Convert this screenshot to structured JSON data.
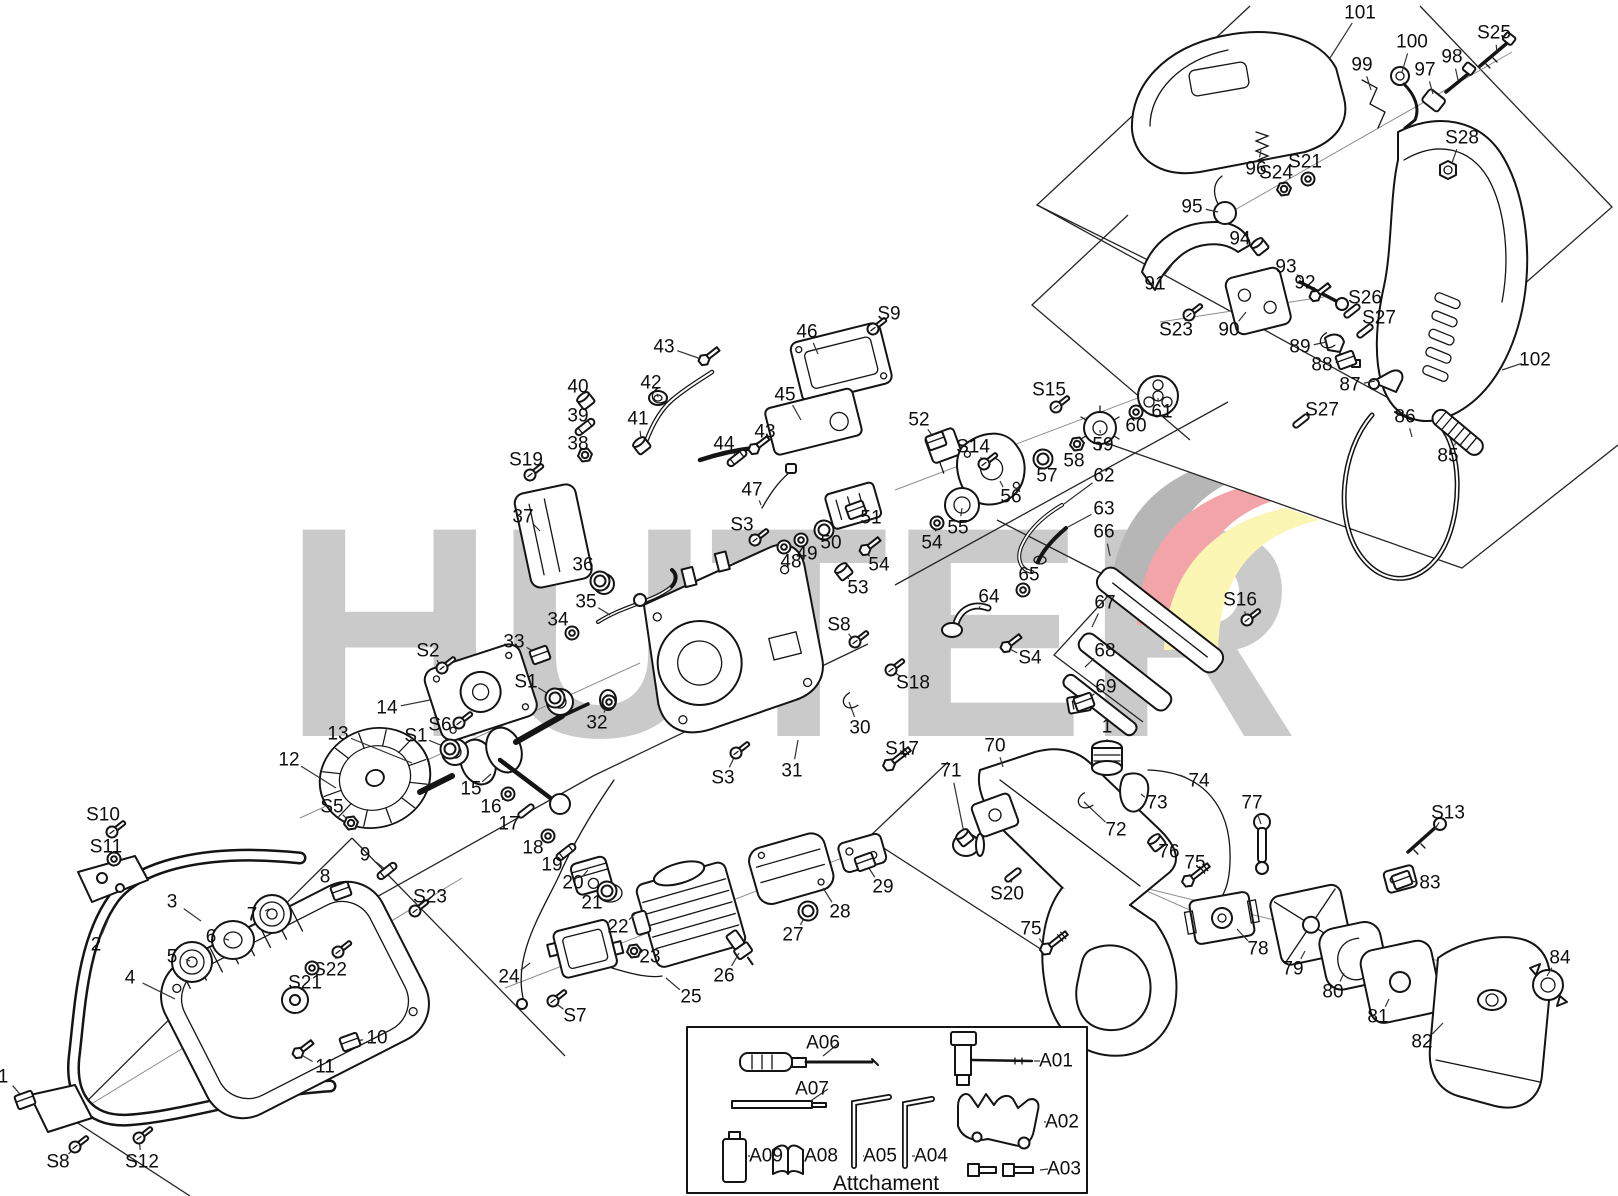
{
  "watermark": {
    "text": "HUTER",
    "letter_color": "#cacaca",
    "flag_colors": {
      "gray": "#b6b6b6",
      "red": "#f2a4a9",
      "yellow": "#fbf6b4"
    }
  },
  "attachment_box": {
    "caption": "Attchament",
    "items": [
      {
        "label": "A06",
        "x": 823,
        "y": 1043,
        "lx": 823,
        "ly": 1056
      },
      {
        "label": "A07",
        "x": 812,
        "y": 1089,
        "lx": 812,
        "ly": 1100
      },
      {
        "label": "A09",
        "x": 766,
        "y": 1156,
        "lx": 748,
        "ly": 1156
      },
      {
        "label": "A08",
        "x": 821,
        "y": 1156,
        "lx": 805,
        "ly": 1156
      },
      {
        "label": "A05",
        "x": 880,
        "y": 1156,
        "lx": 863,
        "ly": 1156
      },
      {
        "label": "A04",
        "x": 931,
        "y": 1156,
        "lx": 912,
        "ly": 1156
      },
      {
        "label": "A01",
        "x": 1056,
        "y": 1061,
        "lx": 1034,
        "ly": 1061
      },
      {
        "label": "A02",
        "x": 1062,
        "y": 1122,
        "lx": 1044,
        "ly": 1122
      },
      {
        "label": "A03",
        "x": 1064,
        "y": 1169,
        "lx": 1040,
        "ly": 1170
      }
    ]
  },
  "diagram": {
    "labels": [
      [
        "101",
        1360,
        13,
        1330,
        58,
        ""
      ],
      [
        "100",
        1412,
        42,
        1402,
        72,
        ""
      ],
      [
        "99",
        1362,
        65,
        1371,
        90,
        ""
      ],
      [
        "98",
        1452,
        57,
        1458,
        80,
        ""
      ],
      [
        "97",
        1425,
        70,
        1433,
        94,
        ""
      ],
      [
        "S25",
        1494,
        33,
        1497,
        52,
        ""
      ],
      [
        "S28",
        1462,
        138,
        1452,
        163,
        ""
      ],
      [
        "96",
        1256,
        169,
        1261,
        150,
        ""
      ],
      [
        "S24",
        1276,
        173,
        1284,
        189,
        "nut"
      ],
      [
        "S21",
        1305,
        162,
        1308,
        179,
        "washer"
      ],
      [
        "95",
        1192,
        207,
        1218,
        212,
        ""
      ],
      [
        "94",
        1240,
        239,
        1260,
        247,
        "cap"
      ],
      [
        "93",
        1286,
        267,
        1301,
        279,
        ""
      ],
      [
        "92",
        1305,
        283,
        1315,
        296,
        "bolt"
      ],
      [
        "91",
        1155,
        284,
        1172,
        265,
        ""
      ],
      [
        "90",
        1229,
        330,
        1246,
        312,
        ""
      ],
      [
        "S23",
        1176,
        330,
        1189,
        315,
        "screw"
      ],
      [
        "S26",
        1365,
        298,
        1352,
        311,
        "pin"
      ],
      [
        "S27",
        1379,
        318,
        1365,
        331,
        "pin"
      ],
      [
        "89",
        1300,
        347,
        1326,
        342,
        "clip"
      ],
      [
        "88",
        1322,
        365,
        1346,
        360,
        "block"
      ],
      [
        "87",
        1350,
        385,
        1375,
        381,
        ""
      ],
      [
        "102",
        1535,
        360,
        1502,
        370,
        ""
      ],
      [
        "86",
        1405,
        417,
        1412,
        437,
        ""
      ],
      [
        "85",
        1448,
        456,
        1456,
        441,
        ""
      ],
      [
        "S27",
        1322,
        410,
        1301,
        421,
        "pin"
      ],
      [
        "S15",
        1049,
        390,
        1056,
        407,
        "screw"
      ],
      [
        "S16",
        1240,
        600,
        1247,
        620,
        "screw"
      ],
      [
        "52",
        919,
        420,
        936,
        441,
        "block"
      ],
      [
        "S14",
        973,
        447,
        984,
        464,
        "screw"
      ],
      [
        "56",
        1011,
        497,
        1000,
        481,
        ""
      ],
      [
        "57",
        1047,
        476,
        1043,
        459,
        "ring"
      ],
      [
        "58",
        1074,
        461,
        1077,
        444,
        "nut"
      ],
      [
        "59",
        1103,
        445,
        1100,
        430,
        ""
      ],
      [
        "60",
        1136,
        426,
        1136,
        412,
        "washer"
      ],
      [
        "61",
        1162,
        412,
        1158,
        398,
        ""
      ],
      [
        "55",
        958,
        528,
        962,
        508,
        ""
      ],
      [
        "54",
        932,
        543,
        937,
        523,
        "washer"
      ],
      [
        "62",
        1104,
        476,
        1064,
        504,
        ""
      ],
      [
        "63",
        1104,
        509,
        1068,
        527,
        ""
      ],
      [
        "66",
        1104,
        532,
        1110,
        556,
        ""
      ],
      [
        "65",
        1029,
        575,
        1023,
        590,
        "washer"
      ],
      [
        "64",
        989,
        597,
        979,
        609,
        ""
      ],
      [
        "S4",
        1030,
        658,
        1006,
        647,
        "bolt"
      ],
      [
        "67",
        1105,
        603,
        1092,
        627,
        ""
      ],
      [
        "68",
        1105,
        651,
        1085,
        667,
        ""
      ],
      [
        "69",
        1106,
        687,
        1084,
        702,
        "block"
      ],
      [
        "S18",
        913,
        683,
        891,
        670,
        "screw"
      ],
      [
        "S8",
        839,
        625,
        855,
        642,
        "screw"
      ],
      [
        "30",
        860,
        728,
        849,
        702,
        "clip"
      ],
      [
        "S17",
        902,
        749,
        889,
        765,
        "lbolt"
      ],
      [
        "1",
        1107,
        727,
        1107,
        741,
        ""
      ],
      [
        "S9",
        889,
        314,
        873,
        329,
        "screw"
      ],
      [
        "46",
        807,
        332,
        818,
        354,
        ""
      ],
      [
        "43",
        664,
        347,
        704,
        360,
        "bolt"
      ],
      [
        "42",
        651,
        383,
        658,
        397,
        "clip"
      ],
      [
        "40",
        578,
        387,
        586,
        401,
        "cap"
      ],
      [
        "39",
        578,
        416,
        585,
        427,
        "tube"
      ],
      [
        "38",
        578,
        444,
        585,
        455,
        "nut"
      ],
      [
        "41",
        638,
        419,
        642,
        446,
        "cap"
      ],
      [
        "S19",
        526,
        460,
        530,
        475,
        "screw"
      ],
      [
        "37",
        523,
        517,
        540,
        531,
        ""
      ],
      [
        "44",
        724,
        444,
        737,
        458,
        "tube"
      ],
      [
        "43",
        765,
        432,
        754,
        449,
        "bolt"
      ],
      [
        "45",
        785,
        395,
        801,
        420,
        ""
      ],
      [
        "47",
        752,
        490,
        761,
        505,
        ""
      ],
      [
        "S3",
        742,
        525,
        755,
        540,
        "screw"
      ],
      [
        "48",
        791,
        562,
        784,
        547,
        "washer"
      ],
      [
        "49",
        807,
        554,
        801,
        540,
        "washer"
      ],
      [
        "50",
        831,
        543,
        824,
        530,
        "ring"
      ],
      [
        "51",
        871,
        518,
        856,
        510,
        "block"
      ],
      [
        "53",
        858,
        588,
        844,
        572,
        "cap"
      ],
      [
        "54",
        879,
        565,
        865,
        550,
        "bolt"
      ],
      [
        "36",
        583,
        565,
        600,
        581,
        "ring"
      ],
      [
        "35",
        586,
        602,
        610,
        615,
        ""
      ],
      [
        "34",
        558,
        620,
        572,
        633,
        "washer"
      ],
      [
        "33",
        514,
        642,
        540,
        655,
        "block"
      ],
      [
        "S2",
        428,
        651,
        442,
        668,
        "screw"
      ],
      [
        "S1",
        526,
        682,
        555,
        698,
        "ring"
      ],
      [
        "32",
        597,
        723,
        609,
        702,
        "washer"
      ],
      [
        "14",
        387,
        708,
        430,
        700,
        ""
      ],
      [
        "S6",
        440,
        725,
        459,
        723,
        "screw"
      ],
      [
        "S1",
        416,
        736,
        450,
        749,
        "ring"
      ],
      [
        "13",
        338,
        734,
        412,
        763,
        ""
      ],
      [
        "12",
        289,
        760,
        336,
        788,
        ""
      ],
      [
        "S5",
        332,
        807,
        351,
        823,
        "nut"
      ],
      [
        "15",
        471,
        789,
        491,
        774,
        ""
      ],
      [
        "16",
        491,
        807,
        508,
        794,
        "washer"
      ],
      [
        "17",
        509,
        824,
        526,
        811,
        "pin"
      ],
      [
        "18",
        533,
        848,
        548,
        836,
        "washer"
      ],
      [
        "19",
        552,
        865,
        566,
        852,
        "tube"
      ],
      [
        "20",
        573,
        883,
        588,
        870,
        ""
      ],
      [
        "21",
        592,
        903,
        607,
        891,
        "ring"
      ],
      [
        "22",
        618,
        927,
        635,
        914,
        ""
      ],
      [
        "23",
        650,
        957,
        634,
        951,
        "nut"
      ],
      [
        "24",
        509,
        977,
        530,
        963,
        ""
      ],
      [
        "25",
        691,
        997,
        666,
        978,
        ""
      ],
      [
        "26",
        724,
        976,
        739,
        953,
        ""
      ],
      [
        "27",
        793,
        935,
        808,
        911,
        "ring"
      ],
      [
        "28",
        840,
        912,
        823,
        888,
        ""
      ],
      [
        "29",
        883,
        887,
        865,
        862,
        "block"
      ],
      [
        "31",
        792,
        771,
        798,
        740,
        ""
      ],
      [
        "S3",
        723,
        778,
        736,
        753,
        "screw"
      ],
      [
        "S7",
        575,
        1016,
        553,
        1001,
        "screw"
      ],
      [
        "S10",
        103,
        815,
        112,
        832,
        "screw"
      ],
      [
        "S11",
        106,
        847,
        114,
        859,
        "washer"
      ],
      [
        "2",
        96,
        945,
        108,
        920,
        ""
      ],
      [
        "3",
        172,
        902,
        201,
        921,
        ""
      ],
      [
        "9",
        365,
        855,
        387,
        871,
        "tube"
      ],
      [
        "8",
        325,
        877,
        341,
        891,
        "block"
      ],
      [
        "7",
        252,
        915,
        269,
        909,
        ""
      ],
      [
        "6",
        211,
        937,
        229,
        940,
        ""
      ],
      [
        "5",
        172,
        957,
        190,
        961,
        ""
      ],
      [
        "4",
        130,
        978,
        175,
        999,
        ""
      ],
      [
        "S23",
        430,
        897,
        415,
        911,
        "screw"
      ],
      [
        "S22",
        330,
        970,
        338,
        952,
        "screw"
      ],
      [
        "S21",
        305,
        983,
        312,
        968,
        "washer"
      ],
      [
        "10",
        377,
        1038,
        350,
        1042,
        "block"
      ],
      [
        "11",
        325,
        1067,
        298,
        1053,
        "bolt"
      ],
      [
        "1",
        3,
        1077,
        25,
        1100,
        "block"
      ],
      [
        "S8",
        58,
        1162,
        75,
        1147,
        "screw"
      ],
      [
        "S12",
        142,
        1162,
        139,
        1138,
        "screw"
      ],
      [
        "70",
        995,
        746,
        1003,
        767,
        ""
      ],
      [
        "71",
        951,
        771,
        965,
        838,
        "cap"
      ],
      [
        "72",
        1116,
        830,
        1084,
        802,
        "clip"
      ],
      [
        "73",
        1157,
        803,
        1141,
        794,
        ""
      ],
      [
        "74",
        1199,
        781,
        1180,
        775,
        ""
      ],
      [
        "76",
        1169,
        852,
        1157,
        843,
        "cap"
      ],
      [
        "75",
        1195,
        863,
        1188,
        881,
        "lbolt"
      ],
      [
        "77",
        1252,
        803,
        1261,
        824,
        ""
      ],
      [
        "S20",
        1007,
        894,
        1013,
        875,
        "pin"
      ],
      [
        "75",
        1031,
        929,
        1046,
        949,
        "lbolt"
      ],
      [
        "78",
        1258,
        949,
        1237,
        929,
        ""
      ],
      [
        "79",
        1293,
        969,
        1305,
        951,
        ""
      ],
      [
        "80",
        1333,
        992,
        1344,
        973,
        ""
      ],
      [
        "81",
        1378,
        1017,
        1389,
        999,
        ""
      ],
      [
        "82",
        1422,
        1042,
        1443,
        1023,
        ""
      ],
      [
        "83",
        1430,
        883,
        1402,
        880,
        "block"
      ],
      [
        "84",
        1560,
        958,
        1547,
        976,
        ""
      ],
      [
        "S13",
        1448,
        813,
        1435,
        829,
        ""
      ]
    ],
    "boundaries": [
      [
        [
          1250,
          6
        ],
        [
          1037,
          205
        ],
        [
          1392,
          400
        ],
        [
          1612,
          207
        ],
        [
          1420,
          6
        ]
      ],
      [
        [
          1037,
          205
        ],
        [
          1152,
          262
        ]
      ],
      [
        [
          1128,
          215
        ],
        [
          1032,
          305
        ],
        [
          1190,
          440
        ]
      ],
      [
        [
          1098,
          440
        ],
        [
          1462,
          568
        ],
        [
          1618,
          445
        ]
      ],
      [
        [
          352,
          838
        ],
        [
          70,
          1118
        ],
        [
          190,
          1196
        ]
      ],
      [
        [
          352,
          838
        ],
        [
          565,
          1056
        ]
      ],
      [
        [
          205,
          993
        ],
        [
          593,
          776
        ],
        [
          868,
          644
        ]
      ],
      [
        [
          895,
          585
        ],
        [
          1228,
          402
        ]
      ],
      [
        [
          997,
          520
        ],
        [
          1120,
          583
        ],
        [
          1054,
          655
        ],
        [
          1143,
          722
        ]
      ],
      [
        [
          948,
          762
        ],
        [
          868,
          838
        ],
        [
          1092,
          982
        ]
      ]
    ],
    "axes": [
      [
        [
          88,
          1106
        ],
        [
          462,
          878
        ]
      ],
      [
        [
          300,
          818
        ],
        [
          640,
          663
        ]
      ],
      [
        [
          505,
          988
        ],
        [
          868,
          848
        ]
      ],
      [
        [
          895,
          490
        ],
        [
          1172,
          385
        ]
      ],
      [
        [
          1196,
          232
        ],
        [
          1512,
          52
        ]
      ],
      [
        [
          1160,
          322
        ],
        [
          1330,
          296
        ]
      ],
      [
        [
          1145,
          888
        ],
        [
          1548,
          988
        ]
      ],
      [
        [
          1020,
          835
        ],
        [
          1235,
          930
        ]
      ]
    ]
  }
}
